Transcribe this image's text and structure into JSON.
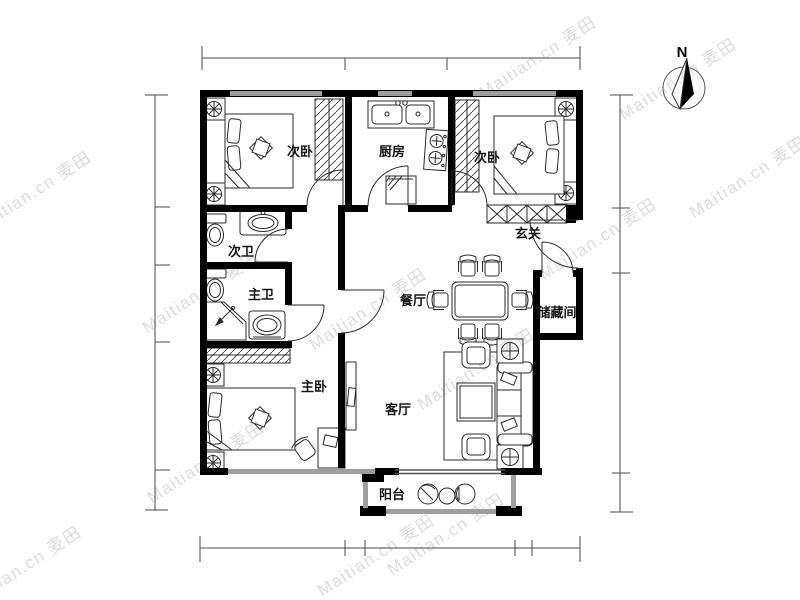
{
  "page": {
    "background": "#ffffff"
  },
  "watermark": {
    "text": "Maitian.cn 麦田"
  },
  "compass": {
    "north_label": "N"
  },
  "rooms": {
    "secondary_bedroom_left": {
      "label": "次卧"
    },
    "kitchen": {
      "label": "厨房"
    },
    "secondary_bedroom_right": {
      "label": "次卧"
    },
    "secondary_bathroom": {
      "label": "次卫"
    },
    "master_bathroom": {
      "label": "主卫"
    },
    "entry": {
      "label": "玄关"
    },
    "dining_room": {
      "label": "餐厅"
    },
    "storage_room": {
      "label": "储藏间"
    },
    "master_bedroom": {
      "label": "主卧"
    },
    "living_room": {
      "label": "客厅"
    },
    "balcony": {
      "label": "阳台"
    }
  },
  "colors": {
    "wall": "#000000",
    "window": "#9e9e9e",
    "furniture_line": "#2b2b2b",
    "dimension_line": "#4a4a4a",
    "watermark": "#dcdcdc",
    "label": "#151515"
  }
}
